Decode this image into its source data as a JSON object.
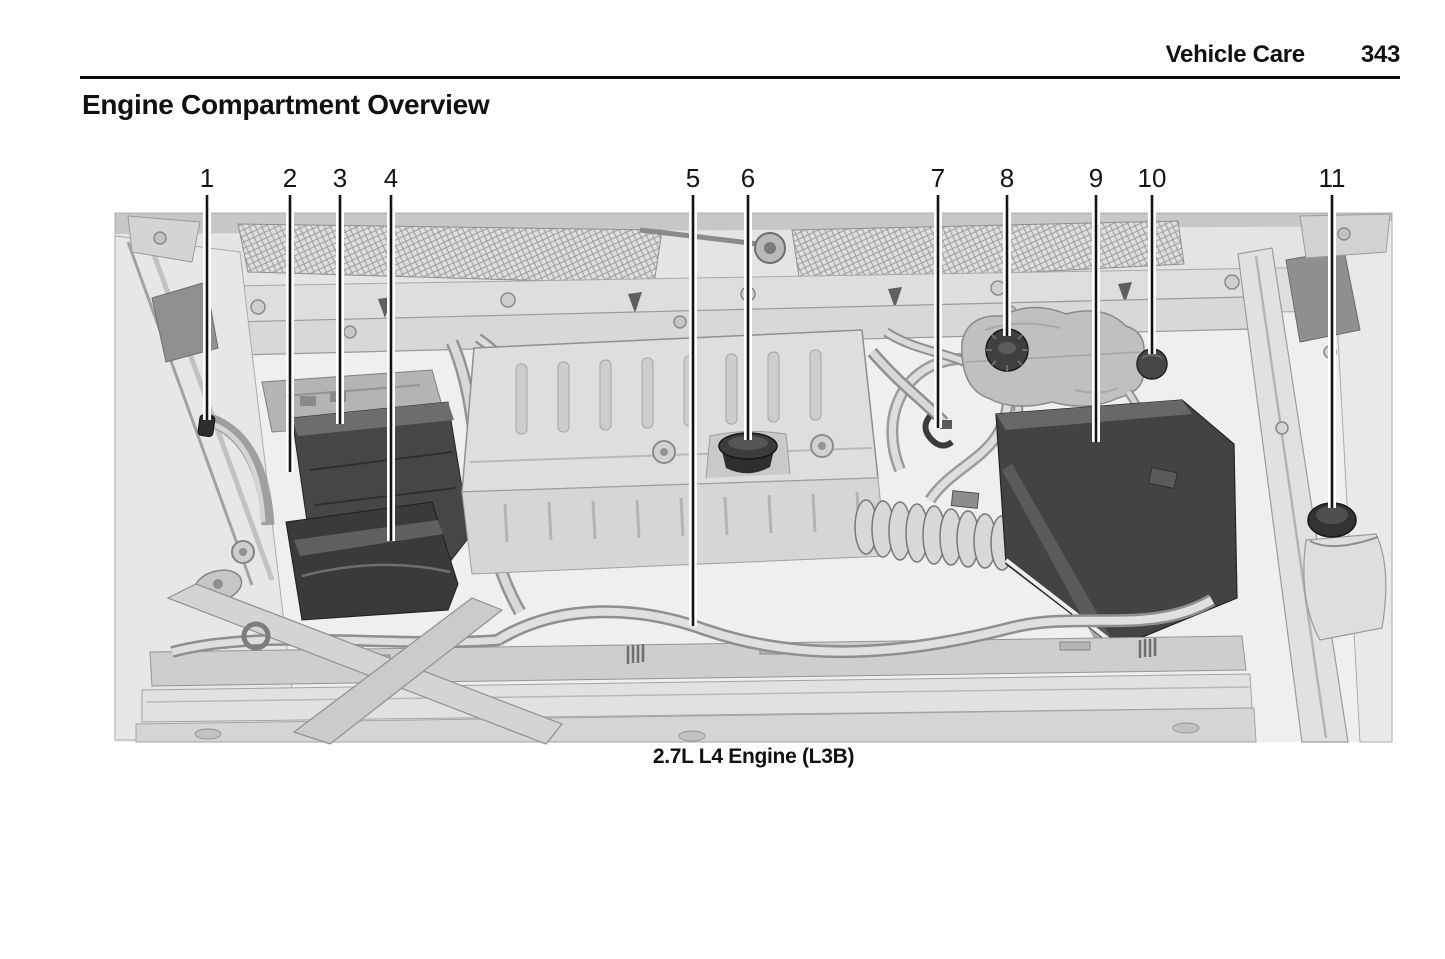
{
  "header": {
    "section_title": "Vehicle Care",
    "page_number": "343"
  },
  "page_title": "Engine Compartment Overview",
  "figure": {
    "caption": "2.7L L4 Engine (L3B)",
    "callouts": [
      {
        "label": "1",
        "x": 207,
        "line_top": 195,
        "line_end": 420
      },
      {
        "label": "2",
        "x": 290,
        "line_top": 195,
        "line_end": 472
      },
      {
        "label": "3",
        "x": 340,
        "line_top": 195,
        "line_end": 424
      },
      {
        "label": "4",
        "x": 391,
        "line_top": 195,
        "line_end": 541
      },
      {
        "label": "5",
        "x": 693,
        "line_top": 195,
        "line_end": 626
      },
      {
        "label": "6",
        "x": 748,
        "line_top": 195,
        "line_end": 440
      },
      {
        "label": "7",
        "x": 938,
        "line_top": 195,
        "line_end": 428
      },
      {
        "label": "8",
        "x": 1007,
        "line_top": 195,
        "line_end": 336
      },
      {
        "label": "9",
        "x": 1096,
        "line_top": 195,
        "line_end": 442
      },
      {
        "label": "10",
        "x": 1152,
        "line_top": 195,
        "line_end": 354
      },
      {
        "label": "11",
        "x": 1332,
        "line_top": 195,
        "line_end": 508
      }
    ]
  }
}
